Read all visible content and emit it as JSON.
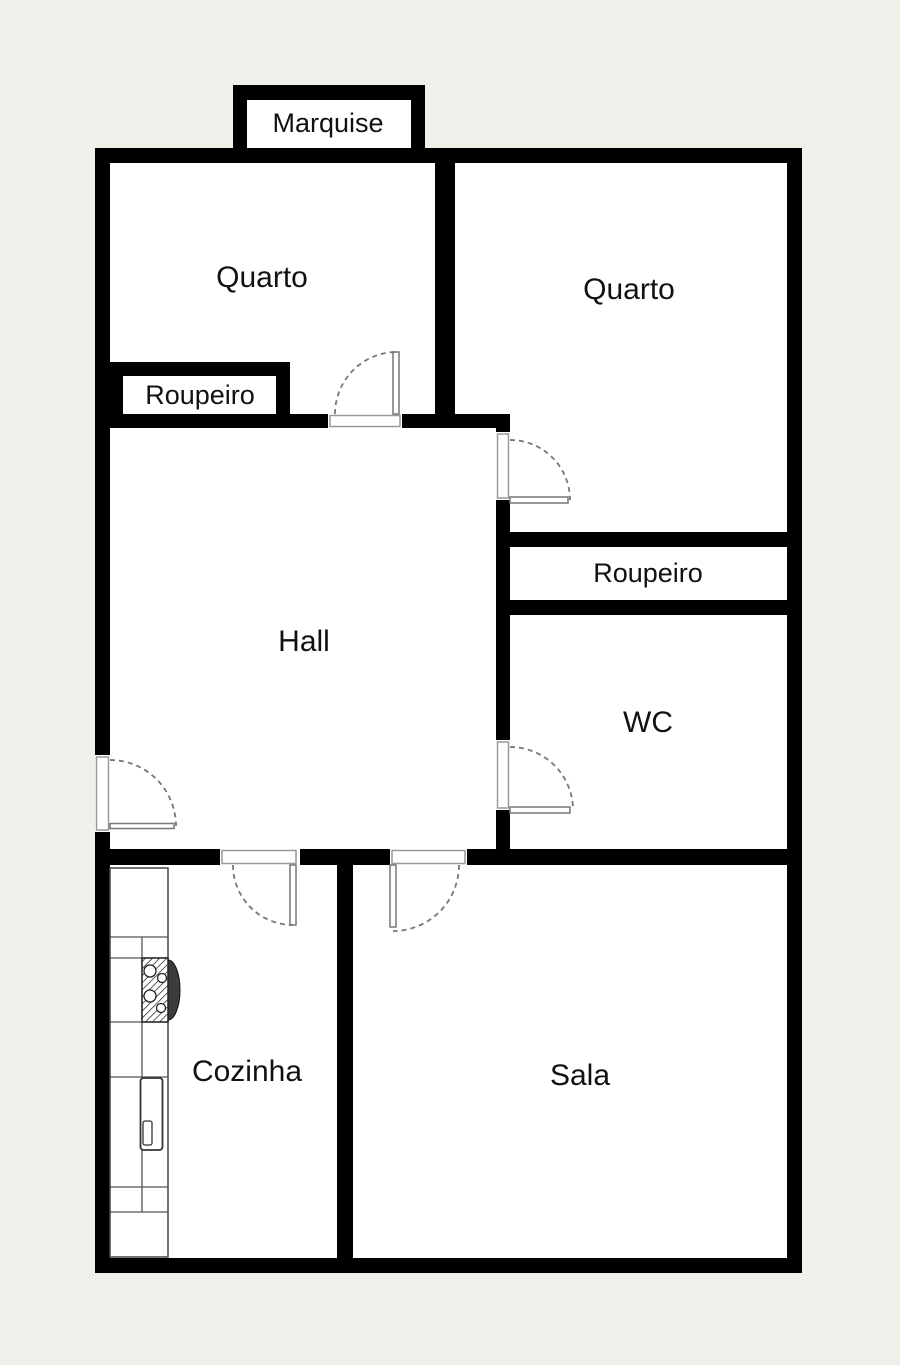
{
  "plan": {
    "type": "apartment-floor-plan",
    "colors": {
      "background": "#f0efe9",
      "walls": "#000000",
      "room_fill": "#ffffff",
      "door_lines": "#777777",
      "fixture_lines": "#444444"
    },
    "rooms": [
      {
        "id": "marquise",
        "label": "Marquise"
      },
      {
        "id": "quarto-left",
        "label": "Quarto"
      },
      {
        "id": "quarto-right",
        "label": "Quarto"
      },
      {
        "id": "roupeiro-left",
        "label": "Roupeiro"
      },
      {
        "id": "hall",
        "label": "Hall"
      },
      {
        "id": "roupeiro-right",
        "label": "Roupeiro"
      },
      {
        "id": "wc",
        "label": "WC"
      },
      {
        "id": "cozinha",
        "label": "Cozinha"
      },
      {
        "id": "sala",
        "label": "Sala"
      }
    ],
    "door_count": 6,
    "fixtures": [
      {
        "name": "kitchen-counter"
      },
      {
        "name": "stove-4-burners"
      },
      {
        "name": "sink"
      }
    ]
  }
}
